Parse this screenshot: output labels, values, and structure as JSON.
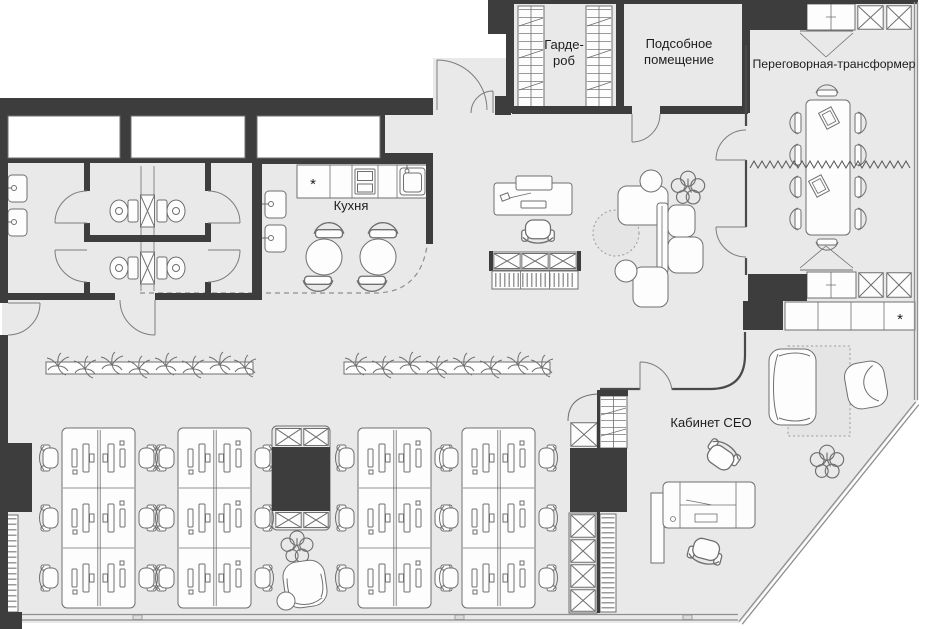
{
  "colors": {
    "wall": "#3d3d3d",
    "floor": "#e9e9e9",
    "glass": "#8f8f8f",
    "line": "#6f6f6f",
    "furniture": "#fdfdfd",
    "rug": "#e5e5e5",
    "text": "#1d1d1d"
  },
  "rooms": {
    "wardrobe": {
      "label": "Гарде-роб",
      "label_line1": "Гарде-",
      "label_line2": "роб"
    },
    "utility": {
      "label": "Подсобное помещение",
      "label_line1": "Подсобное",
      "label_line2": "помещение"
    },
    "meeting": {
      "label": "Переговорная-трансформер"
    },
    "kitchen": {
      "label": "Кухня"
    },
    "ceo": {
      "label": "Кабинет CEO"
    }
  },
  "symbols": {
    "appliance_star": "*"
  }
}
